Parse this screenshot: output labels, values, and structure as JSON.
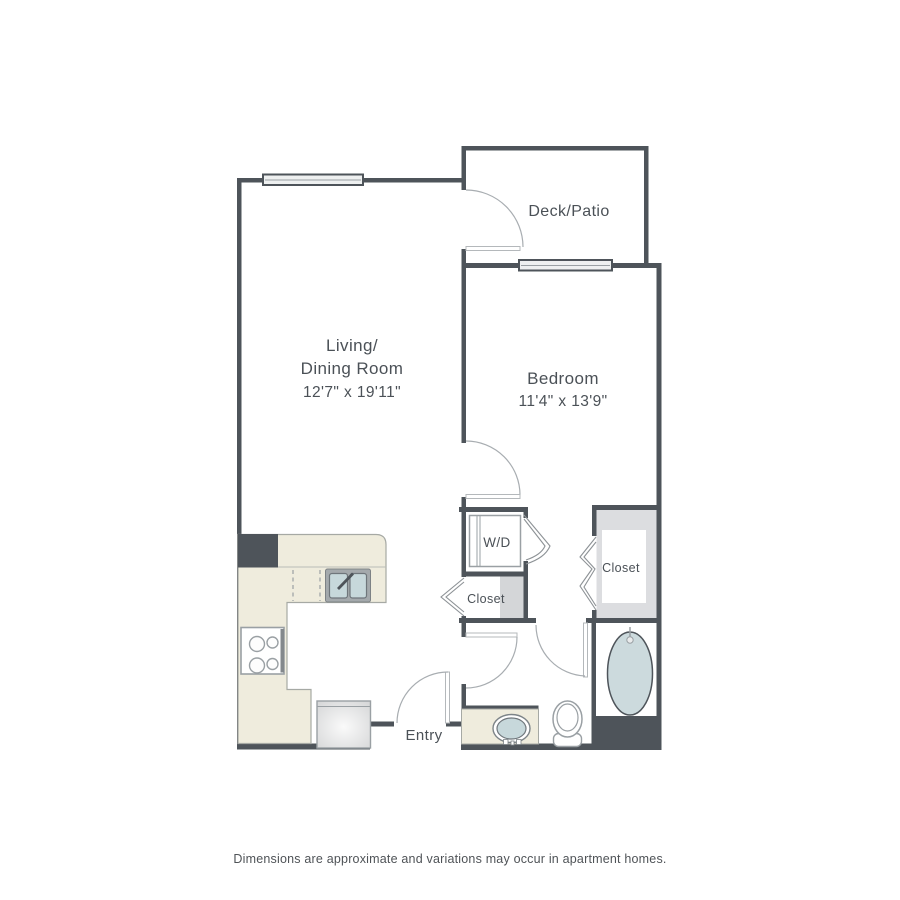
{
  "labels": {
    "living": {
      "line1": "Living/",
      "line2": "Dining Room",
      "dimensions": "12'7\" x 19'11\""
    },
    "bedroom": {
      "name": "Bedroom",
      "dimensions": "11'4\" x 13'9\""
    },
    "deck": {
      "name": "Deck/Patio"
    },
    "entry": {
      "name": "Entry"
    },
    "washer_dryer": {
      "label": "W/D"
    },
    "hall_closet": {
      "label": "Closet"
    },
    "bedroom_closet": {
      "label": "Closet"
    }
  },
  "footer": {
    "disclaimer": "Dimensions are approximate and variations may occur in apartment homes."
  },
  "colors": {
    "wall": "#4e545a",
    "counter_beige": "#efecdd",
    "fixture_water_blue": "#c7d8db",
    "tub_blue": "#ccdadd",
    "closet_gray": "#dcdde0",
    "text": "#4b5157"
  }
}
